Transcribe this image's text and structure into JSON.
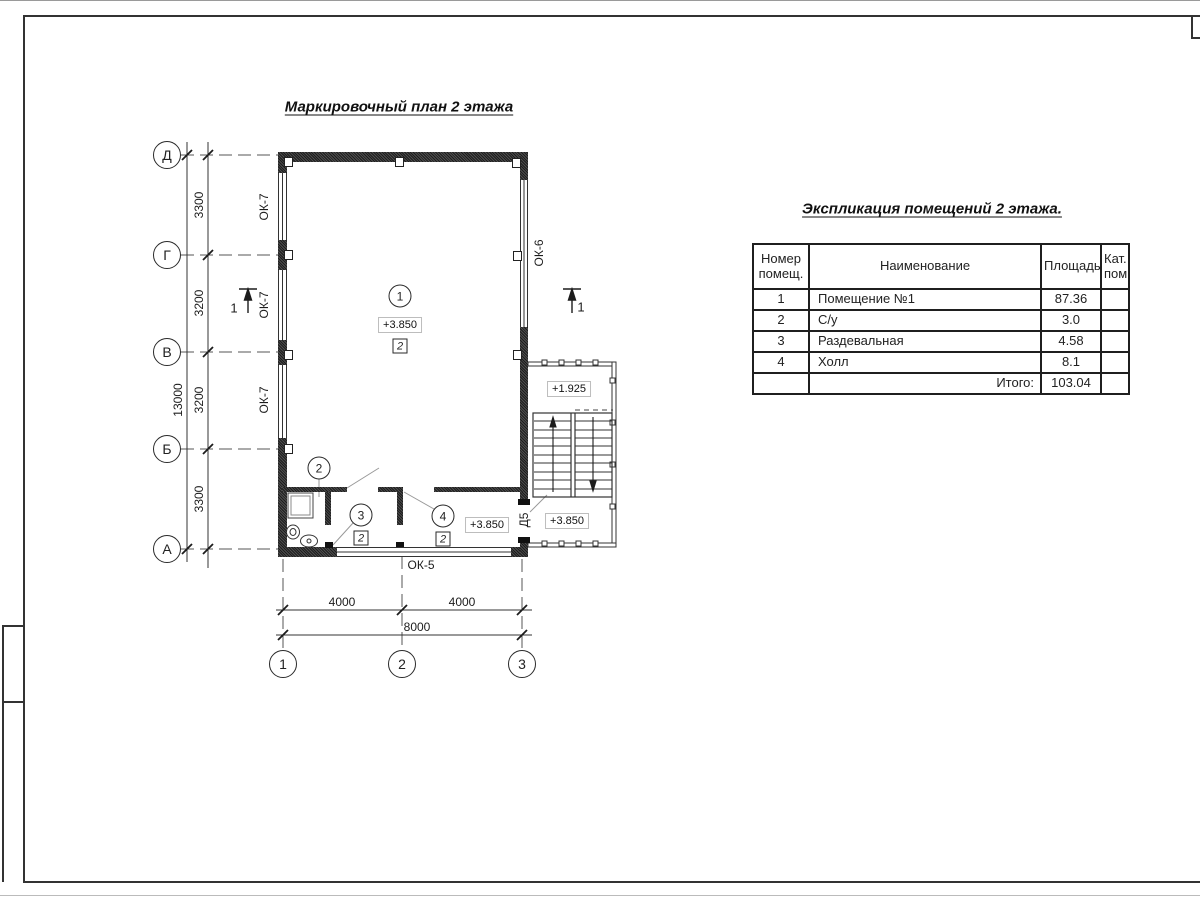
{
  "sheet": {
    "plan_title": "Маркировочный план 2 этажа",
    "paper_color": "#ffffff",
    "line_color": "#333333",
    "wall_color": "#2e2e2e"
  },
  "plan": {
    "axes_left": [
      "Д",
      "Г",
      "В",
      "Б",
      "А"
    ],
    "axes_bottom": [
      "1",
      "2",
      "3"
    ],
    "dims_left": [
      "3300",
      "3200",
      "3200",
      "3300"
    ],
    "dim_left_total": "13000",
    "dims_bottom": [
      "4000",
      "4000"
    ],
    "dim_bottom_total": "8000",
    "window_labels": {
      "left_top": "ОК-7",
      "left_mid": "ОК-7",
      "left_bot": "ОК-7",
      "right": "ОК-6",
      "bottom": "ОК-5"
    },
    "door_label": "Д5",
    "section_mark_left": "1",
    "section_mark_right": "1",
    "rooms": {
      "room1": {
        "number": "1",
        "elevation": "+3.850",
        "cat": "2"
      },
      "room2": {
        "number": "2"
      },
      "room3": {
        "number": "3",
        "cat": "2"
      },
      "room4": {
        "number": "4",
        "cat": "2"
      },
      "hall_elevation": "+3.850",
      "stair_landing_elevation": "+1.925",
      "stair_lower_elevation": "+3.850"
    }
  },
  "table": {
    "title": "Экспликация помещений 2 этажа.",
    "headers": {
      "number": "Номер помещ.",
      "name": "Наименование",
      "area": "Площадь",
      "cat": "Кат. пом."
    },
    "rows": [
      {
        "num": "1",
        "name": "Помещение №1",
        "area": "87.36",
        "cat": ""
      },
      {
        "num": "2",
        "name": "С/у",
        "area": "3.0",
        "cat": ""
      },
      {
        "num": "3",
        "name": "Раздевальная",
        "area": "4.58",
        "cat": ""
      },
      {
        "num": "4",
        "name": "Холл",
        "area": "8.1",
        "cat": ""
      }
    ],
    "total_label": "Итого:",
    "total_value": "103.04"
  }
}
